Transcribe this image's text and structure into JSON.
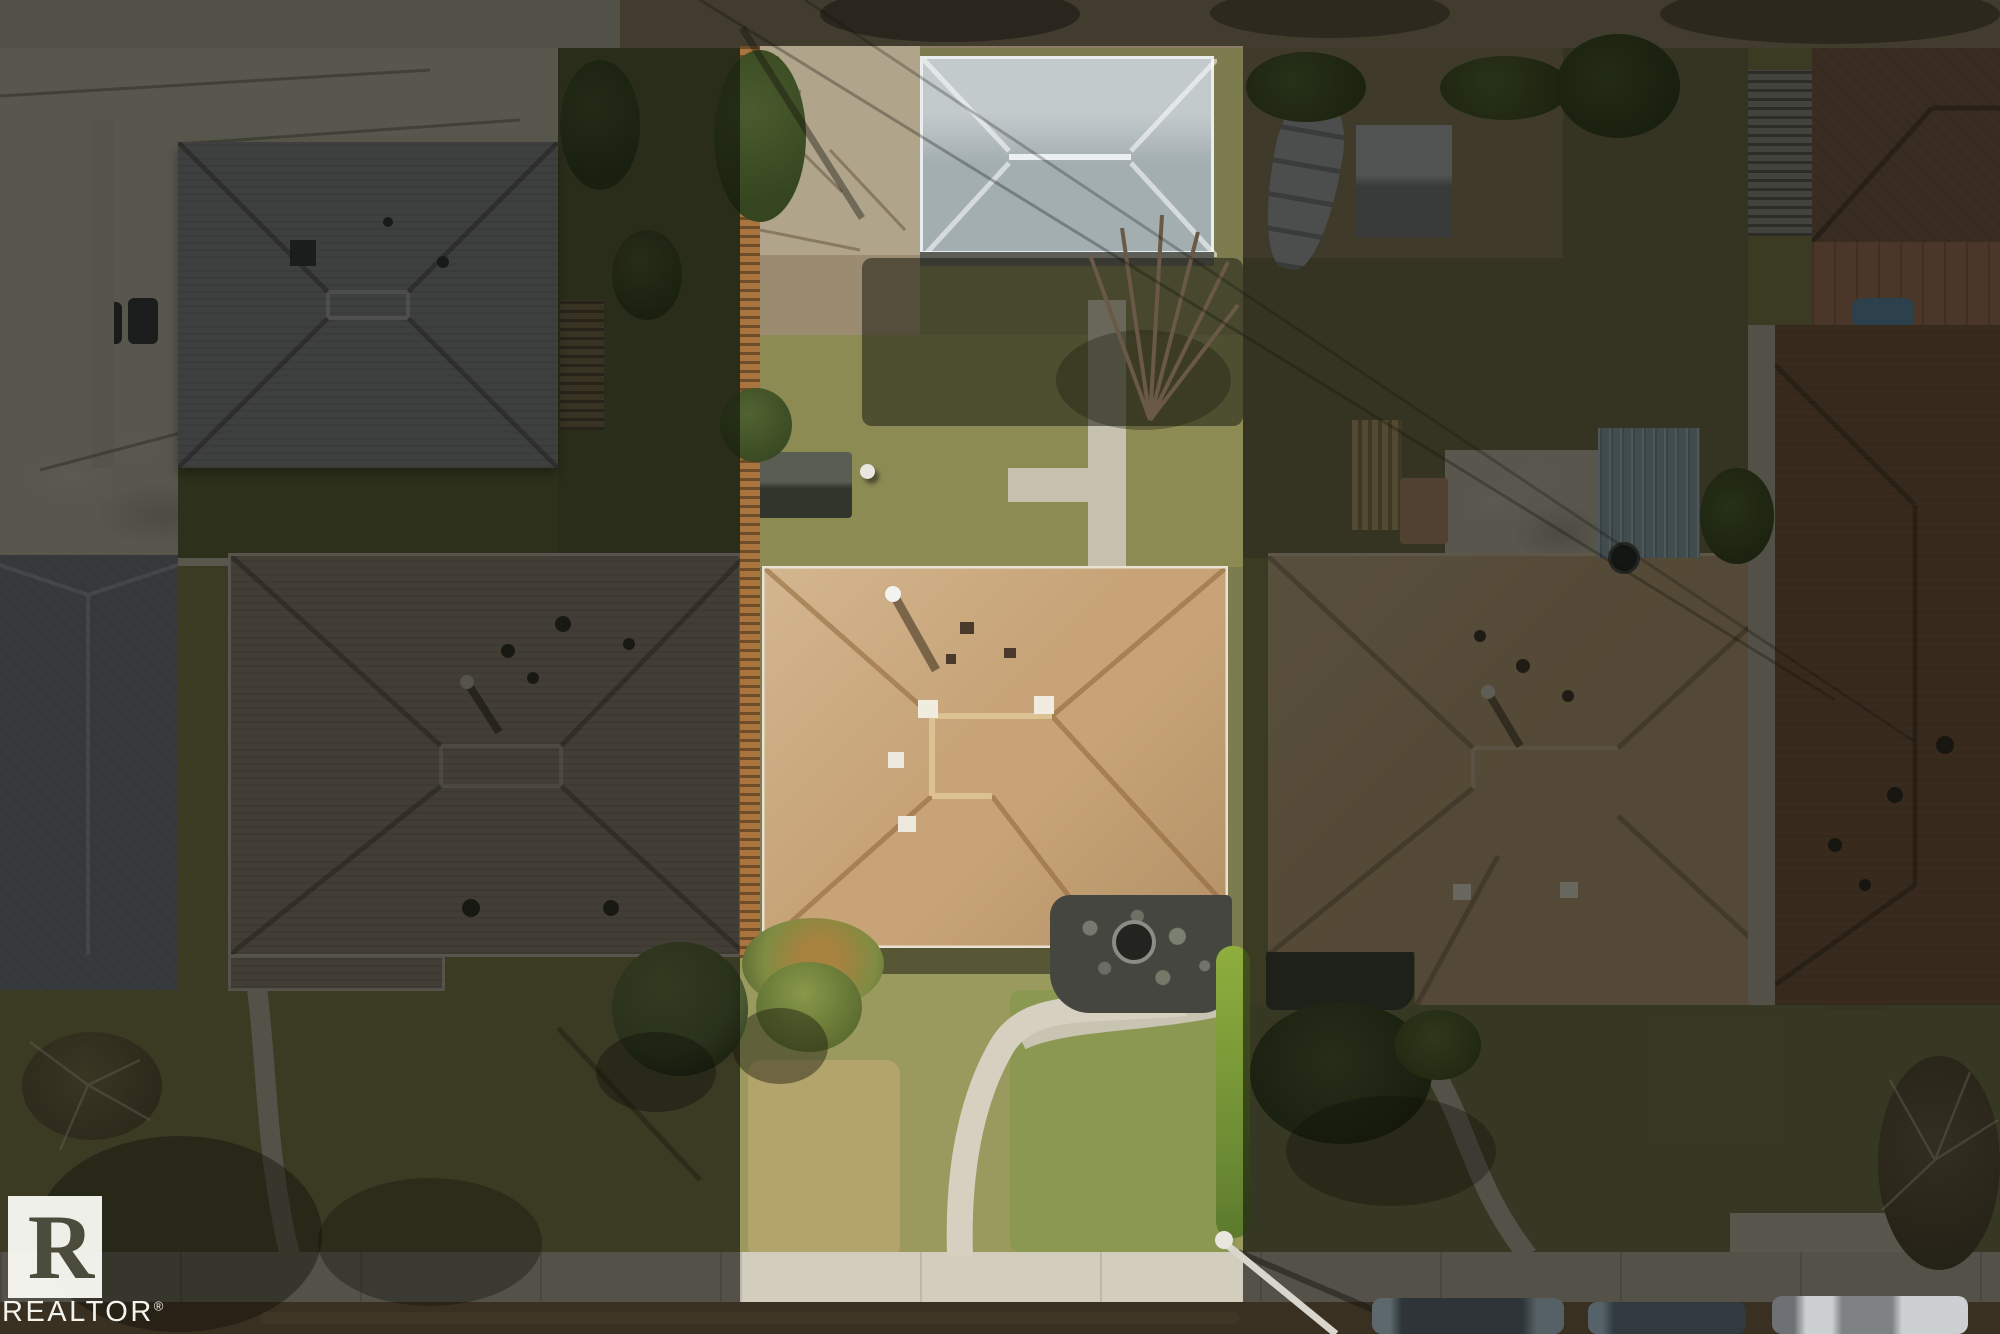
{
  "watermark": {
    "logo_letter": "R",
    "brand": "REALTOR",
    "registered": "®"
  },
  "palette": {
    "concrete": "#c0baab",
    "concrete_bright": "#d3cdbe",
    "pad": "#b0a48b",
    "alley_dirt": "#8e7d66",
    "alley_concrete": "#b3ada0",
    "lawn_dim": "#7d7c4e",
    "lawn_bright": "#9a9a5e",
    "lawn_dead": "#b3a46b",
    "lawn_green": "#8b9852",
    "roof_subject_tan": "#c7a377",
    "roof_garage_gray": "#a3aeb1",
    "roof_left_taupe": "#8d8276",
    "roof_topleft_gray": "#84868d",
    "roof_farleft_gray": "#757a84",
    "roof_right_tan": "#b79c76",
    "roof_farright_brown": "#7a5a48",
    "shed_blue": "#8ba2b1",
    "fence_wood": "#aa743e",
    "hedge_green": "#8fae3e",
    "shrub_green": "#55663a",
    "sidewalk": "#b5afa0",
    "street": "#7a6146",
    "wm_letter": "#4b4c3b"
  }
}
